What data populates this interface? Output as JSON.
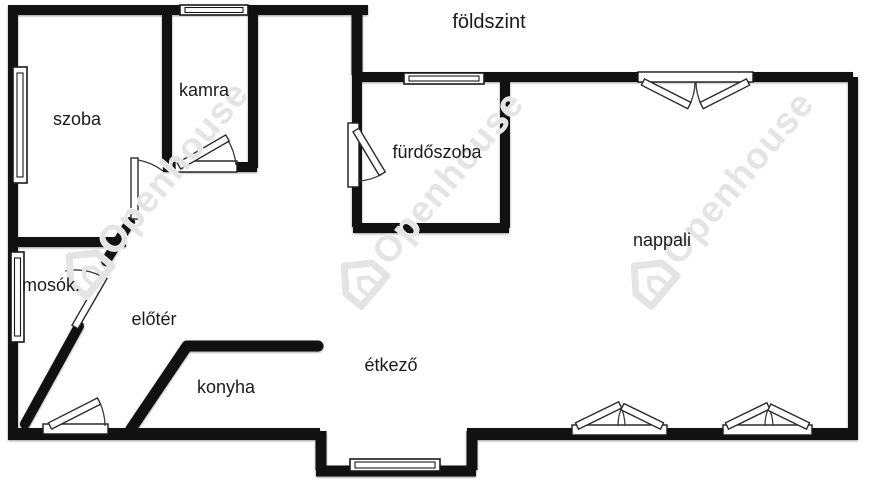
{
  "title": {
    "text": "földszint"
  },
  "rooms": {
    "szoba": {
      "label": "szoba"
    },
    "kamra": {
      "label": "kamra"
    },
    "furdoszoba": {
      "label": "fürdőszoba"
    },
    "nappali": {
      "label": "nappali"
    },
    "mosok": {
      "label": "mosók."
    },
    "eloter": {
      "label": "előtér"
    },
    "konyha": {
      "label": "konyha"
    },
    "etkezo": {
      "label": "étkező"
    }
  },
  "watermark": {
    "text": "Openhouse",
    "color": "#e4e4e4"
  },
  "colors": {
    "background": "#ffffff",
    "wall": "#111111",
    "label": "#1b1b1b"
  }
}
